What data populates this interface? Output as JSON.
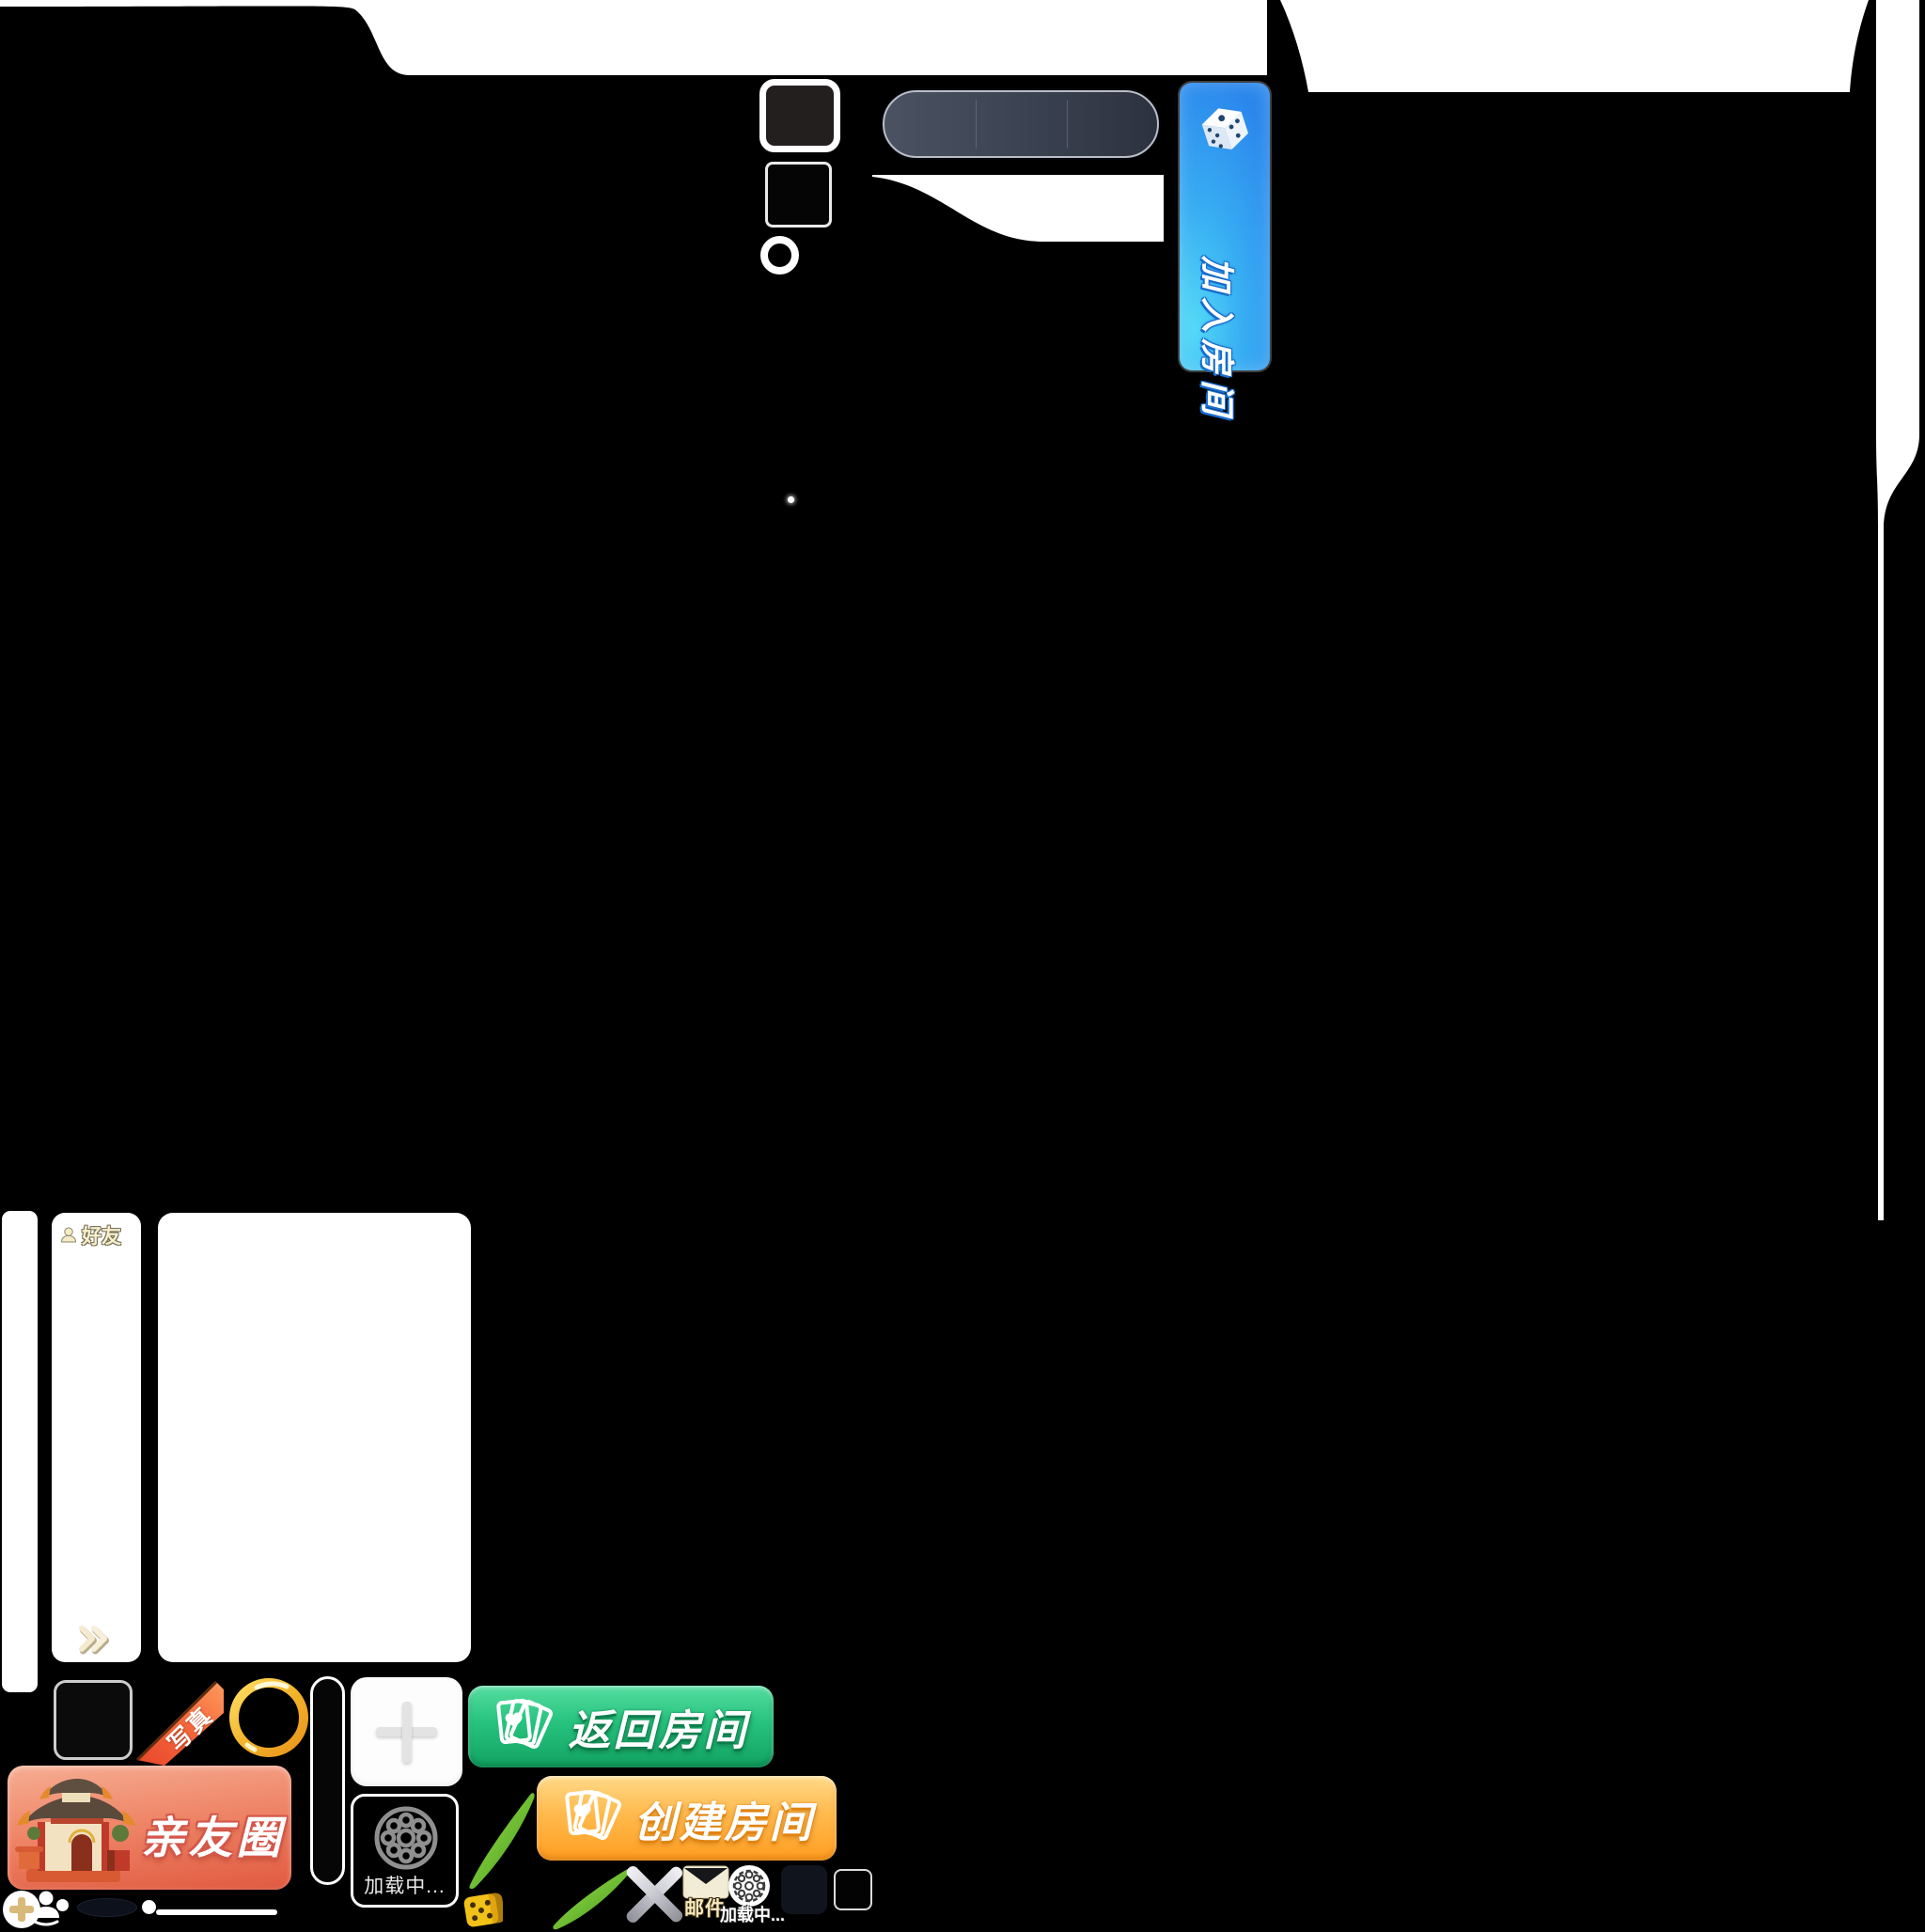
{
  "buttons": {
    "join_room": "加入房间",
    "return_room": "返回房间",
    "create_room": "创建房间",
    "friend_circle": "亲友圈"
  },
  "friends_panel": {
    "title": "好友"
  },
  "corner_ribbon": {
    "text": "写真"
  },
  "loading_tile": {
    "label": "加载中..."
  },
  "bottom_bar": {
    "mail_label": "邮件",
    "loading_label": "加载中..."
  },
  "icons": {
    "join_room_icon": "dice-icon",
    "room_button_icon": "playing-cards-icon",
    "friends_icon": "person-icon",
    "expand_icon": "double-chevron-right-icon",
    "add_icon": "plus-icon",
    "tile_loading_icon": "flower-medallion-icon",
    "mail_icon": "envelope-icon",
    "bottom_loading_icon": "coin-medallion-icon",
    "close_icon": "cross-icon",
    "add_friend_icon": "plus-circle-icon",
    "profile_icon": "person-bust-icon",
    "dice_token": "yellow-dice-icon",
    "decor": "bamboo-leaves"
  },
  "colors": {
    "background": "#000000",
    "join_room_blue": "#2f93ee",
    "return_room_green": "#1fb671",
    "create_room_orange": "#ffae37",
    "friend_circle_red": "#e56a4f",
    "gold_ring": "#f3b32b",
    "ribbon_orange": "#ef5630",
    "panel_white": "#ffffff"
  }
}
